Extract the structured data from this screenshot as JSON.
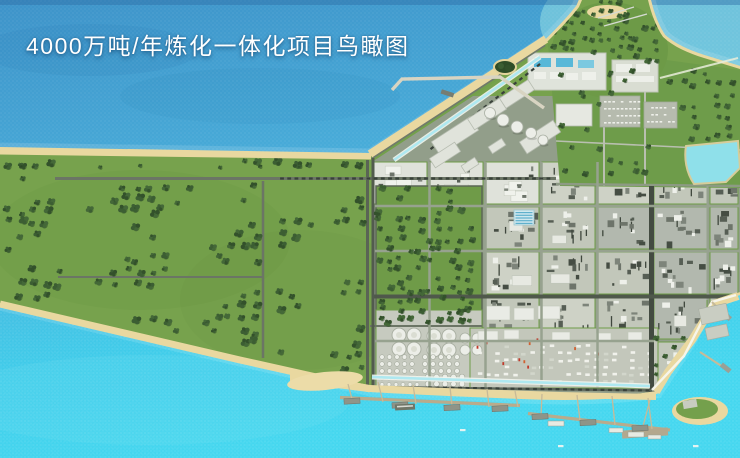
{
  "title": {
    "text": "4000万吨/年炼化一体化项目鸟瞰图"
  },
  "palette": {
    "water_deep": "#3e93c9",
    "water_mid": "#4ab0da",
    "water_bright": "#41d2ec",
    "water_teal": "#93dfe3",
    "sand": "#e9d8a0",
    "grass": "#77a24d",
    "grass_dark": "#6d9a46",
    "tree_dark": "#33512b",
    "tree_mid": "#3c5e33",
    "tree_light": "#446838",
    "block_light": "#ced2c6",
    "block_white": "#dfe2da",
    "block_med": "#c2c7ba",
    "block_dark": "#b2b8ae",
    "equip_dark": "#5d645a",
    "road_light": "#97a28f",
    "road_dark": "#4a5347",
    "hedge_green": "#6f9c48",
    "building_white": "#e9ebe5",
    "pier": "#b9ab8c",
    "trestle": "#c7ba98",
    "breakwater": "#f7f7ee",
    "channel": "#aee8f0",
    "pond": "#8fe0ea",
    "tank_white": "#eceee8",
    "pool_blue": "#58b8d8",
    "flare_red": "#c0392b"
  }
}
